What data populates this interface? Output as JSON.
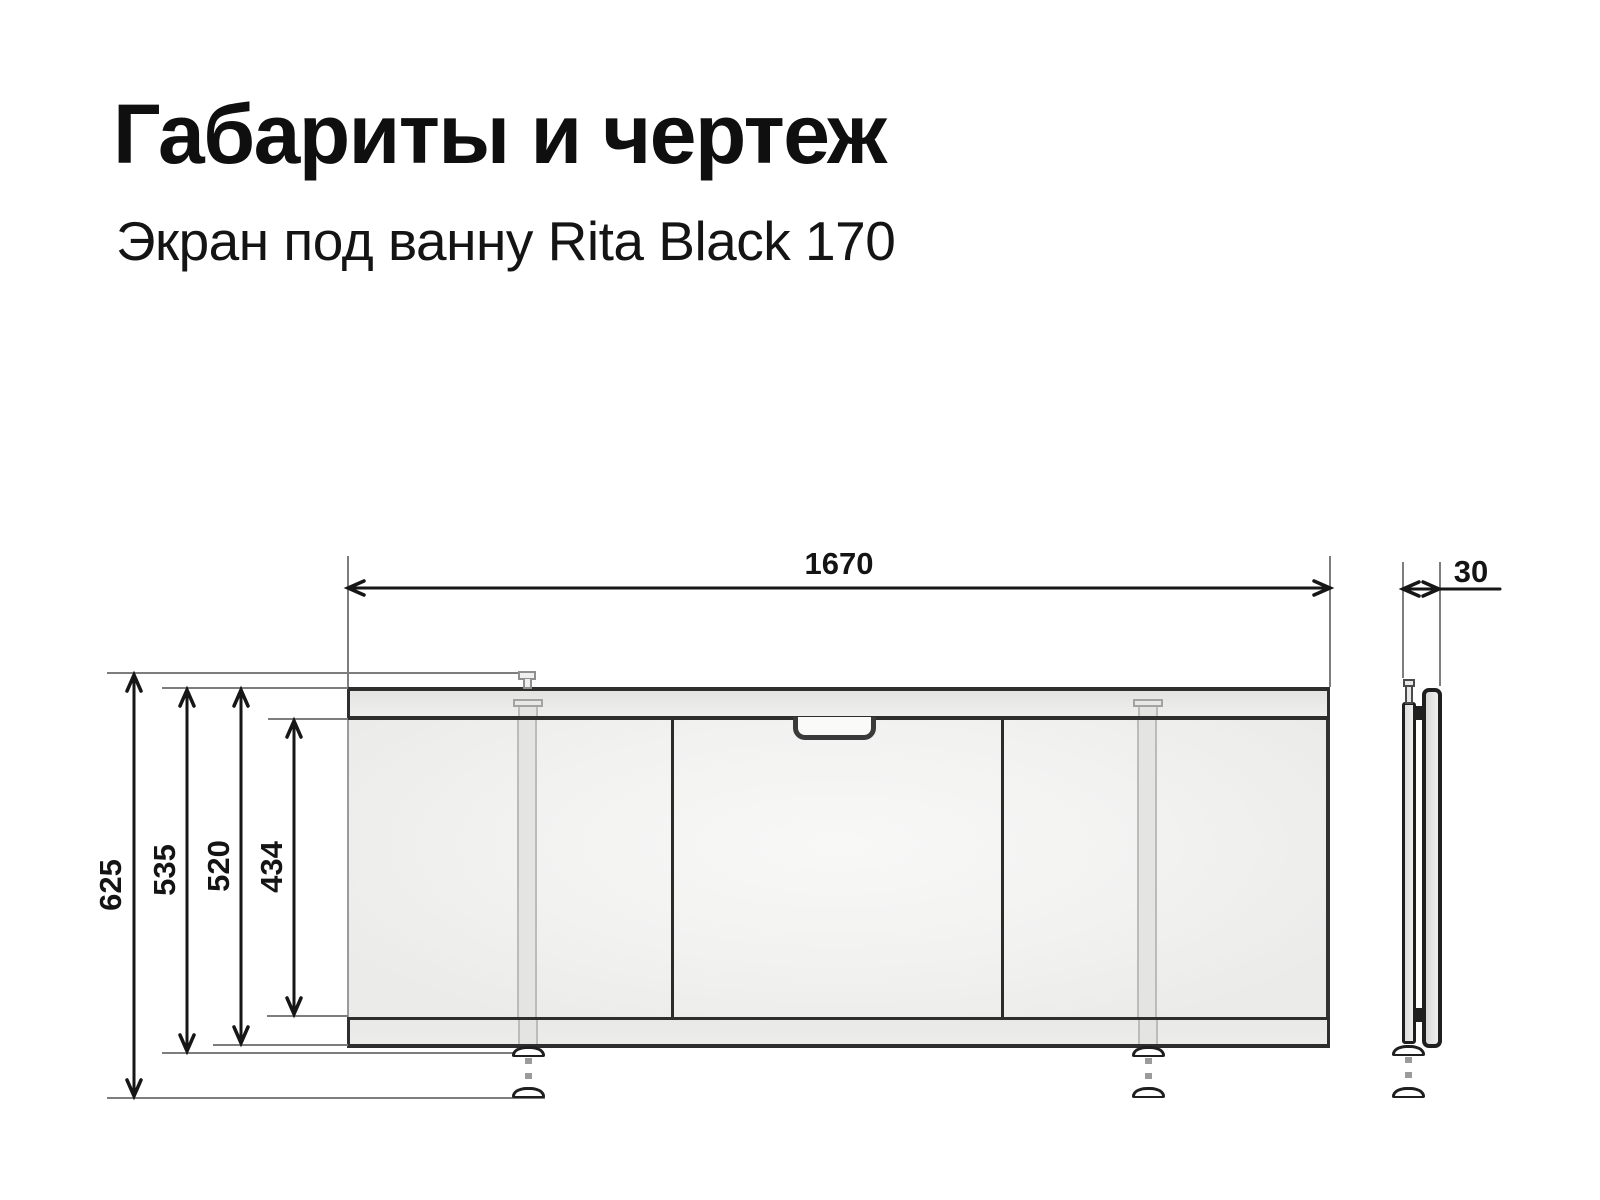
{
  "header": {
    "title": "Габариты и чертеж",
    "subtitle": "Экран под ванну Rita Black 170"
  },
  "dims": {
    "width_mm": "1670",
    "depth_mm": "30",
    "total_height_mm": "625",
    "height_with_feet_mm": "535",
    "panel_height_mm": "520",
    "door_height_mm": "434"
  },
  "colors": {
    "background": "#ffffff",
    "text": "#141414",
    "drawing_line": "#1f1f1f",
    "extension_line": "#7d7d7d",
    "rail_fill": "#e9e9e8",
    "door_fill": "#f2f2f1",
    "leg_fill": "#e4e4e3"
  }
}
